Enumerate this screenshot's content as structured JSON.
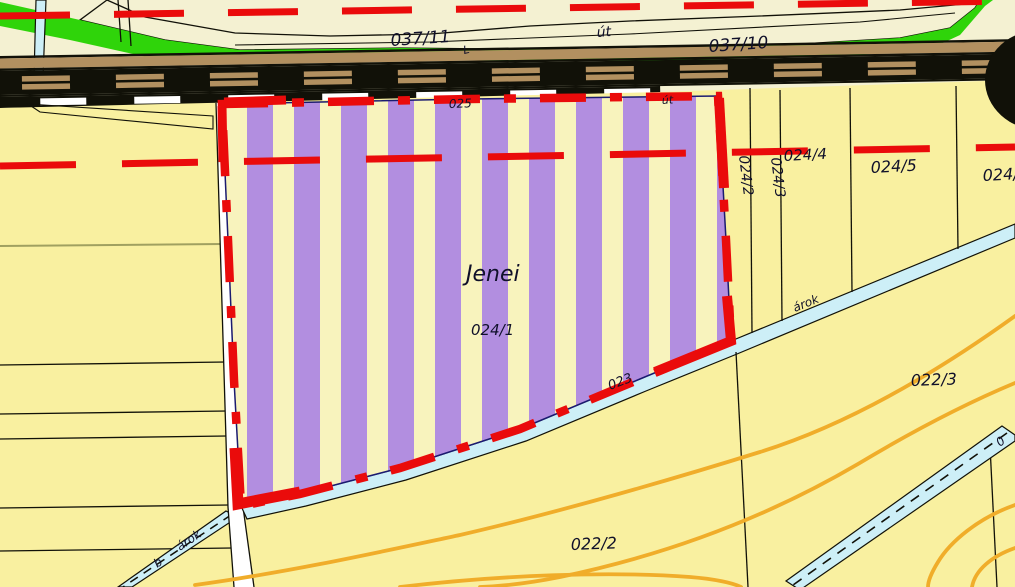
{
  "map_title": "Cadastral map extract (Hungarian land registry)",
  "labels": {
    "parcel_037_11": "037/11",
    "road_abbr_top": "út",
    "parcel_037_10": "037/10",
    "tick_mark": "L",
    "parcel_025": "025",
    "road_abbr_small": "út",
    "owner_name": "Jenei",
    "parcel_024_1": "024/1",
    "parcel_024_2": "024/2",
    "parcel_024_3": "024/3",
    "parcel_024_4": "024/4",
    "parcel_024_5": "024/5",
    "parcel_024_6": "024/6",
    "parcel_022_2": "022/2",
    "parcel_022_3": "022/3",
    "parcel_023": "023",
    "ditch_label_right": "árok",
    "ditch_label_left": "árok",
    "ditch_letter_b": "b",
    "ditch_digit": "0"
  },
  "colors": {
    "background": "#f4f1d2",
    "parcel_yellow": "#f9f0a0",
    "stripe_purple": "#b28ee0",
    "stripe_yellow": "#f8f3bd",
    "highlight_red": "#ea0b0b",
    "vegetation_green": "#2fd40a",
    "railway_tan": "#b29060",
    "water_cyan": "#cdeff7",
    "contour_orange": "#f0ad2a",
    "label_ink": "#10102a",
    "road_white": "#ffffff"
  }
}
